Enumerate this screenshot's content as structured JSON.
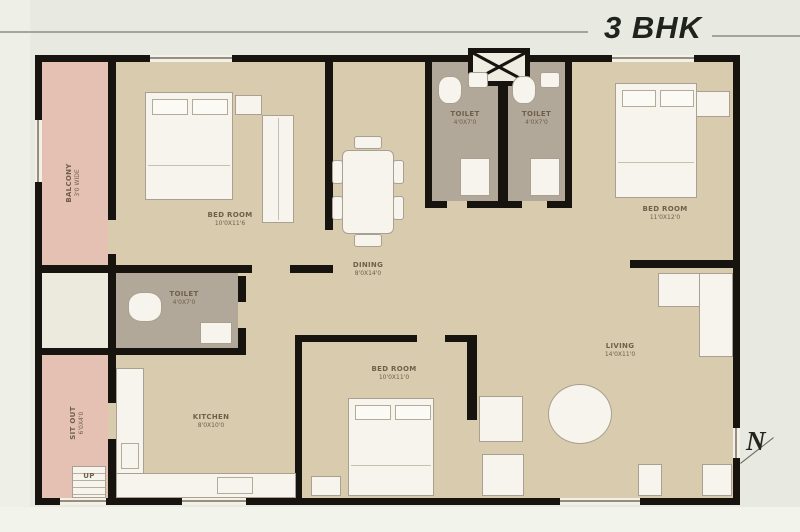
{
  "title": "3 BHK",
  "compass": "N",
  "colors": {
    "wall": "#17130e",
    "floor": "#d8cbae",
    "balcony_pink": "#e5c1b3",
    "toilet_gray": "#b2a899",
    "furniture": "#f6f4ec",
    "page_bg": "#e8e9e1"
  },
  "rooms": [
    {
      "id": "balcony",
      "label": "BALCONY",
      "dims": "3'0 WIDE"
    },
    {
      "id": "bedroom-top-left",
      "label": "BED ROOM",
      "dims": "10'0X11'6"
    },
    {
      "id": "dining",
      "label": "DINING",
      "dims": "8'0X14'0"
    },
    {
      "id": "toilet-top-left",
      "label": "TOILET",
      "dims": "4'0X7'0"
    },
    {
      "id": "toilet-top-right",
      "label": "TOILET",
      "dims": "4'0X7'0"
    },
    {
      "id": "bedroom-right",
      "label": "BED ROOM",
      "dims": "11'0X12'0"
    },
    {
      "id": "toilet-middle",
      "label": "TOILET",
      "dims": "4'0X7'0"
    },
    {
      "id": "kitchen",
      "label": "KITCHEN",
      "dims": "8'0X10'0"
    },
    {
      "id": "sit-out",
      "label": "SIT OUT",
      "dims": "6'0X4'0"
    },
    {
      "id": "bedroom-bottom",
      "label": "BED ROOM",
      "dims": "10'0X11'0"
    },
    {
      "id": "living",
      "label": "LIVING",
      "dims": "14'0X11'0"
    },
    {
      "id": "up",
      "label": "UP"
    }
  ]
}
